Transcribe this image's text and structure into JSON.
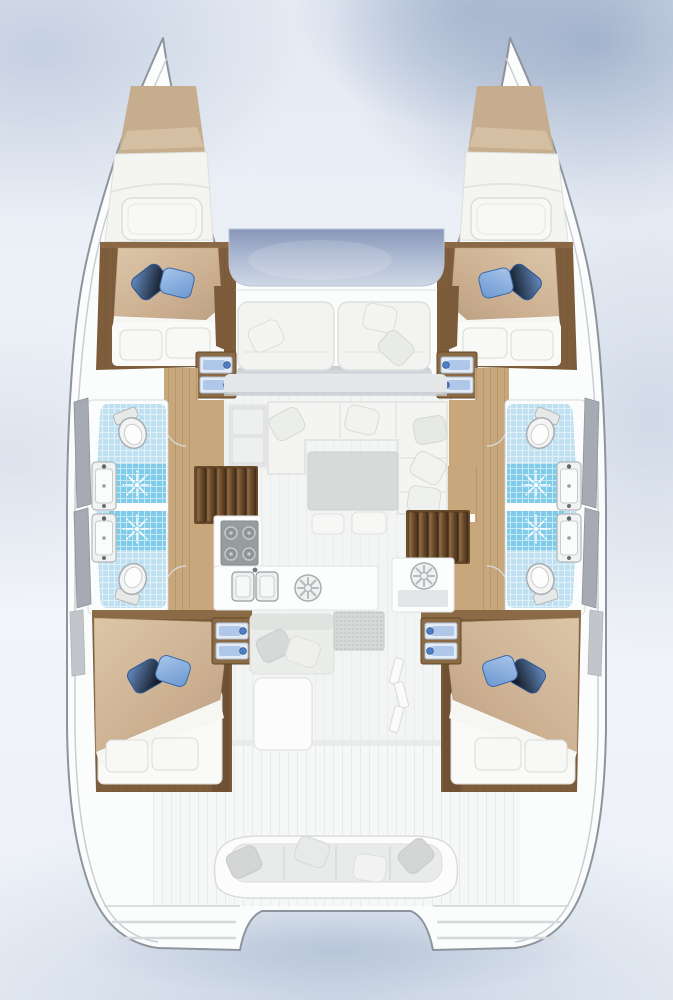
{
  "scene": {
    "type": "floor-plan",
    "subject": "Catamaran sailing yacht layout plan, top-down view",
    "vessel_style": "4 double cabins, 4 bathrooms, saloon with galley, bow trampoline, aft cockpit"
  },
  "areas": [
    {
      "id": "port-bow-storage",
      "name": "port bow storage berth"
    },
    {
      "id": "port-forward-cabin",
      "name": "port forward double cabin"
    },
    {
      "id": "port-forward-bathroom",
      "name": "port forward bathroom with shower"
    },
    {
      "id": "port-aft-bathroom",
      "name": "port aft bathroom with shower"
    },
    {
      "id": "port-aft-cabin",
      "name": "port aft double cabin"
    },
    {
      "id": "starboard-bow-storage",
      "name": "starboard bow storage berth"
    },
    {
      "id": "starboard-forward-cabin",
      "name": "starboard forward double cabin"
    },
    {
      "id": "starboard-forward-bathroom",
      "name": "starboard forward bathroom with shower"
    },
    {
      "id": "starboard-aft-bathroom",
      "name": "starboard aft bathroom with shower"
    },
    {
      "id": "starboard-aft-cabin",
      "name": "starboard aft double cabin"
    },
    {
      "id": "trampoline",
      "name": "bow trampoline"
    },
    {
      "id": "foredeck-lounge",
      "name": "foredeck lounge seating"
    },
    {
      "id": "saloon",
      "name": "saloon with U-sofa and table"
    },
    {
      "id": "galley",
      "name": "galley with stove, double sink and fridges"
    },
    {
      "id": "cockpit",
      "name": "aft cockpit with bench seating"
    },
    {
      "id": "swim-platforms",
      "name": "transom swim platforms"
    }
  ],
  "starboard": {
    "label": "starboard hull: bow berth, forward double cabin, two bathrooms with showers, aft double cabin"
  },
  "fixtures": {
    "toilets": 4,
    "showers": 4,
    "washbasins": 4,
    "double_beds": 4,
    "galley_equipment": [
      "4-burner stove",
      "double sink",
      "round fridge port",
      "round fridge starboard"
    ],
    "companionway_stairs": [
      "port companionway stairs",
      "starboard companionway stairs"
    ],
    "cabin_steps": [
      "port forward cabin steps",
      "port aft cabin steps",
      "starboard forward cabin steps",
      "starboard aft cabin steps"
    ]
  },
  "colors": {
    "background_sky": "#dfe7f2",
    "background_shadow": "#9fb2cc",
    "hull_white": "#fbfcfc",
    "outline_gray": "#8e949d",
    "wood_dark": "#7e5d3c",
    "wood_floor": "#c9a77c",
    "stair_tread": "#6f4e2d",
    "bedding_tan": "#cdb294",
    "pillow_blue_dark": "#3e6cab",
    "pillow_blue_light": "#7fa9dc",
    "tile_light_blue": "#bfe0f0",
    "shower_blue": "#7fcbe9",
    "trampoline_blue": "#93a3c2",
    "cushion_white": "#f3f4f2",
    "table_gray": "#d7dad9"
  }
}
